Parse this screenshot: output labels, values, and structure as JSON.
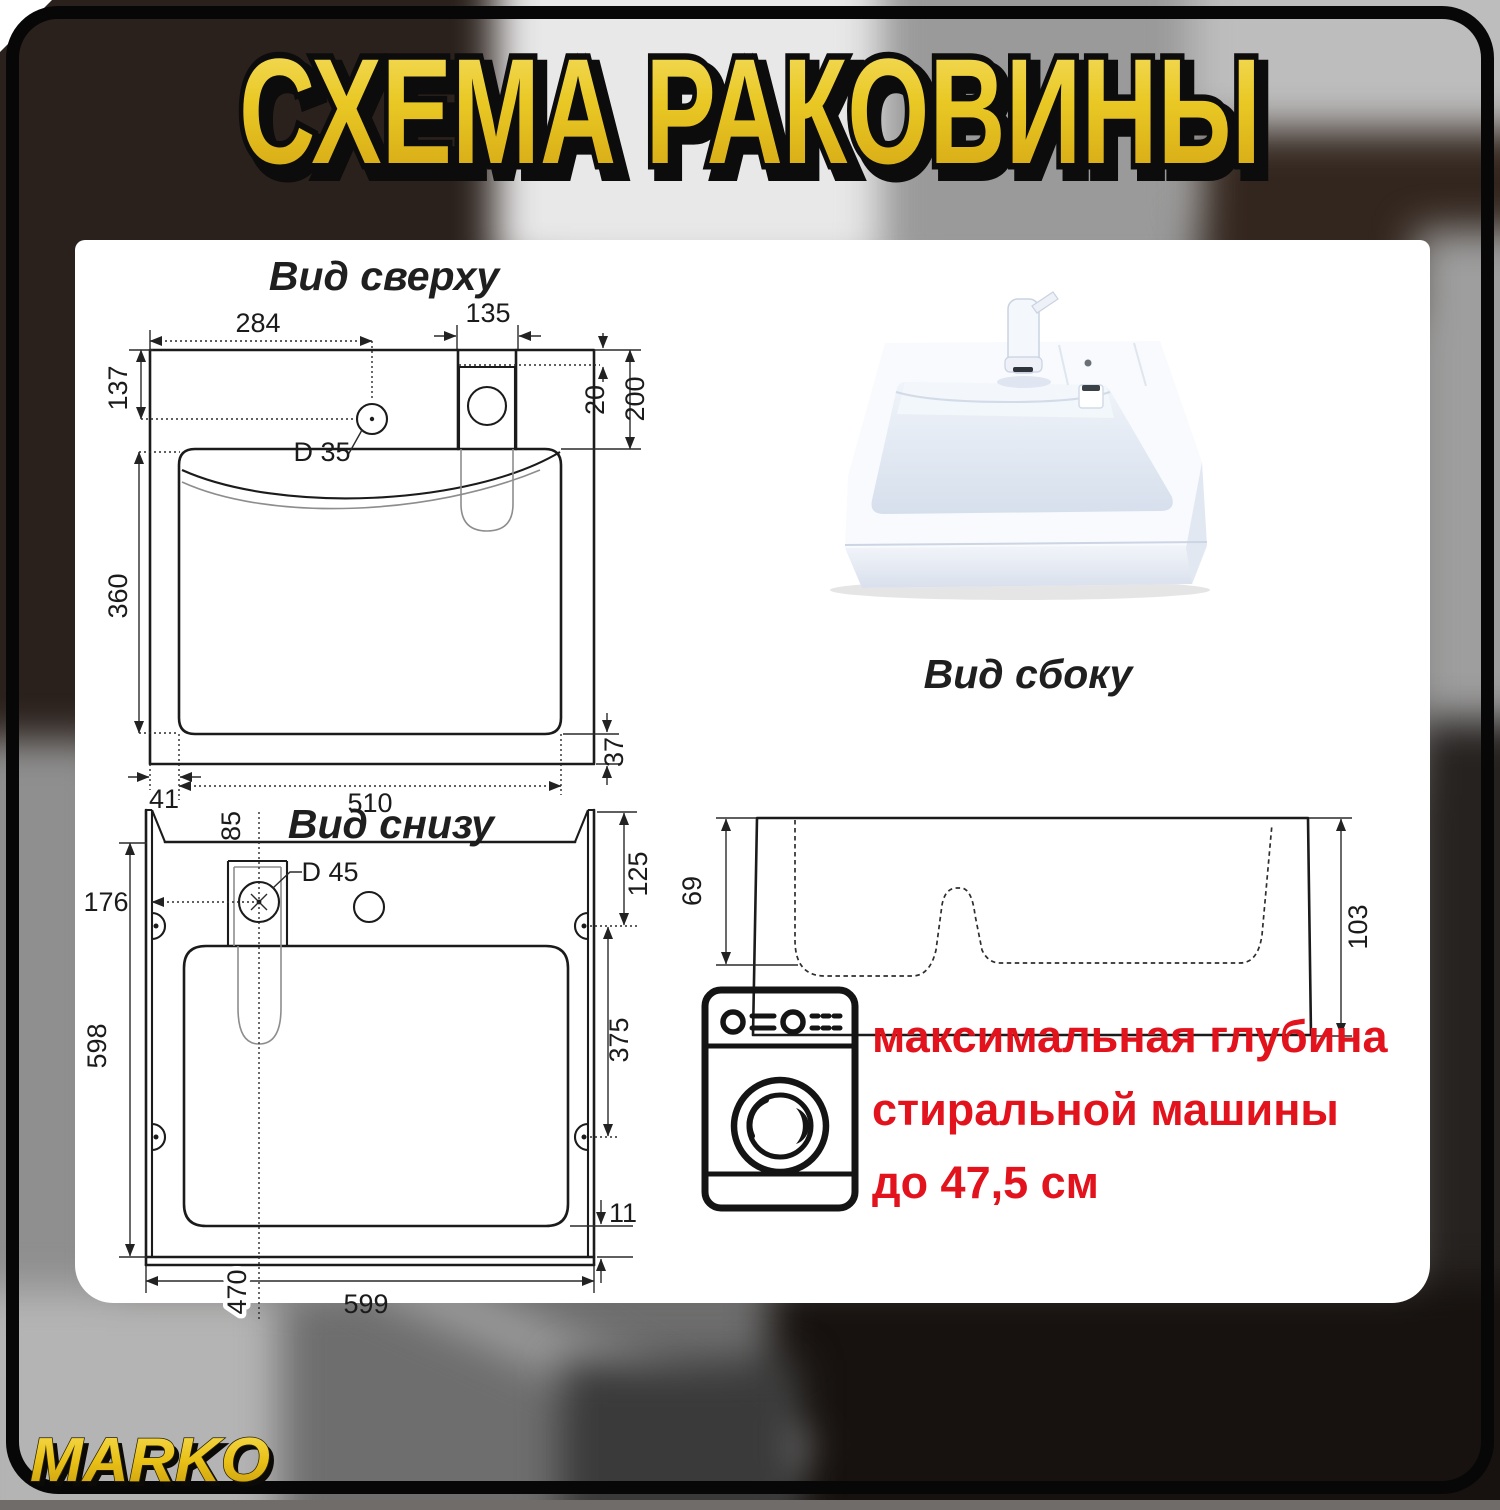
{
  "title": "СХЕМА РАКОВИНЫ",
  "brand": "MARKO",
  "views": {
    "top": {
      "label": "Вид сверху",
      "dims": {
        "width_top": "284",
        "faucet_width": "135",
        "offset_left": "137",
        "ledge": "20",
        "deck_depth": "200",
        "hole": "D 35",
        "basin_depth": "360",
        "margin_left": "41",
        "basin_width": "510",
        "margin_right": "37"
      }
    },
    "bottom": {
      "label": "Вид снизу",
      "dims": {
        "center_offset": "85",
        "drain_left": "176",
        "hole": "D 45",
        "corner_right": "125",
        "height": "598",
        "mount_span": "375",
        "rim": "11",
        "drain_bottom": "470",
        "width": "599"
      }
    },
    "side": {
      "label": "Вид сбоку",
      "dims": {
        "front_depth": "69",
        "back_depth": "103"
      }
    }
  },
  "note": {
    "line1": "максимальная глубина",
    "line2": "стиральной машины",
    "line3": "до 47,5 см"
  },
  "colors": {
    "accent_yellow": "#e9c824",
    "note_red": "#e2131c"
  }
}
